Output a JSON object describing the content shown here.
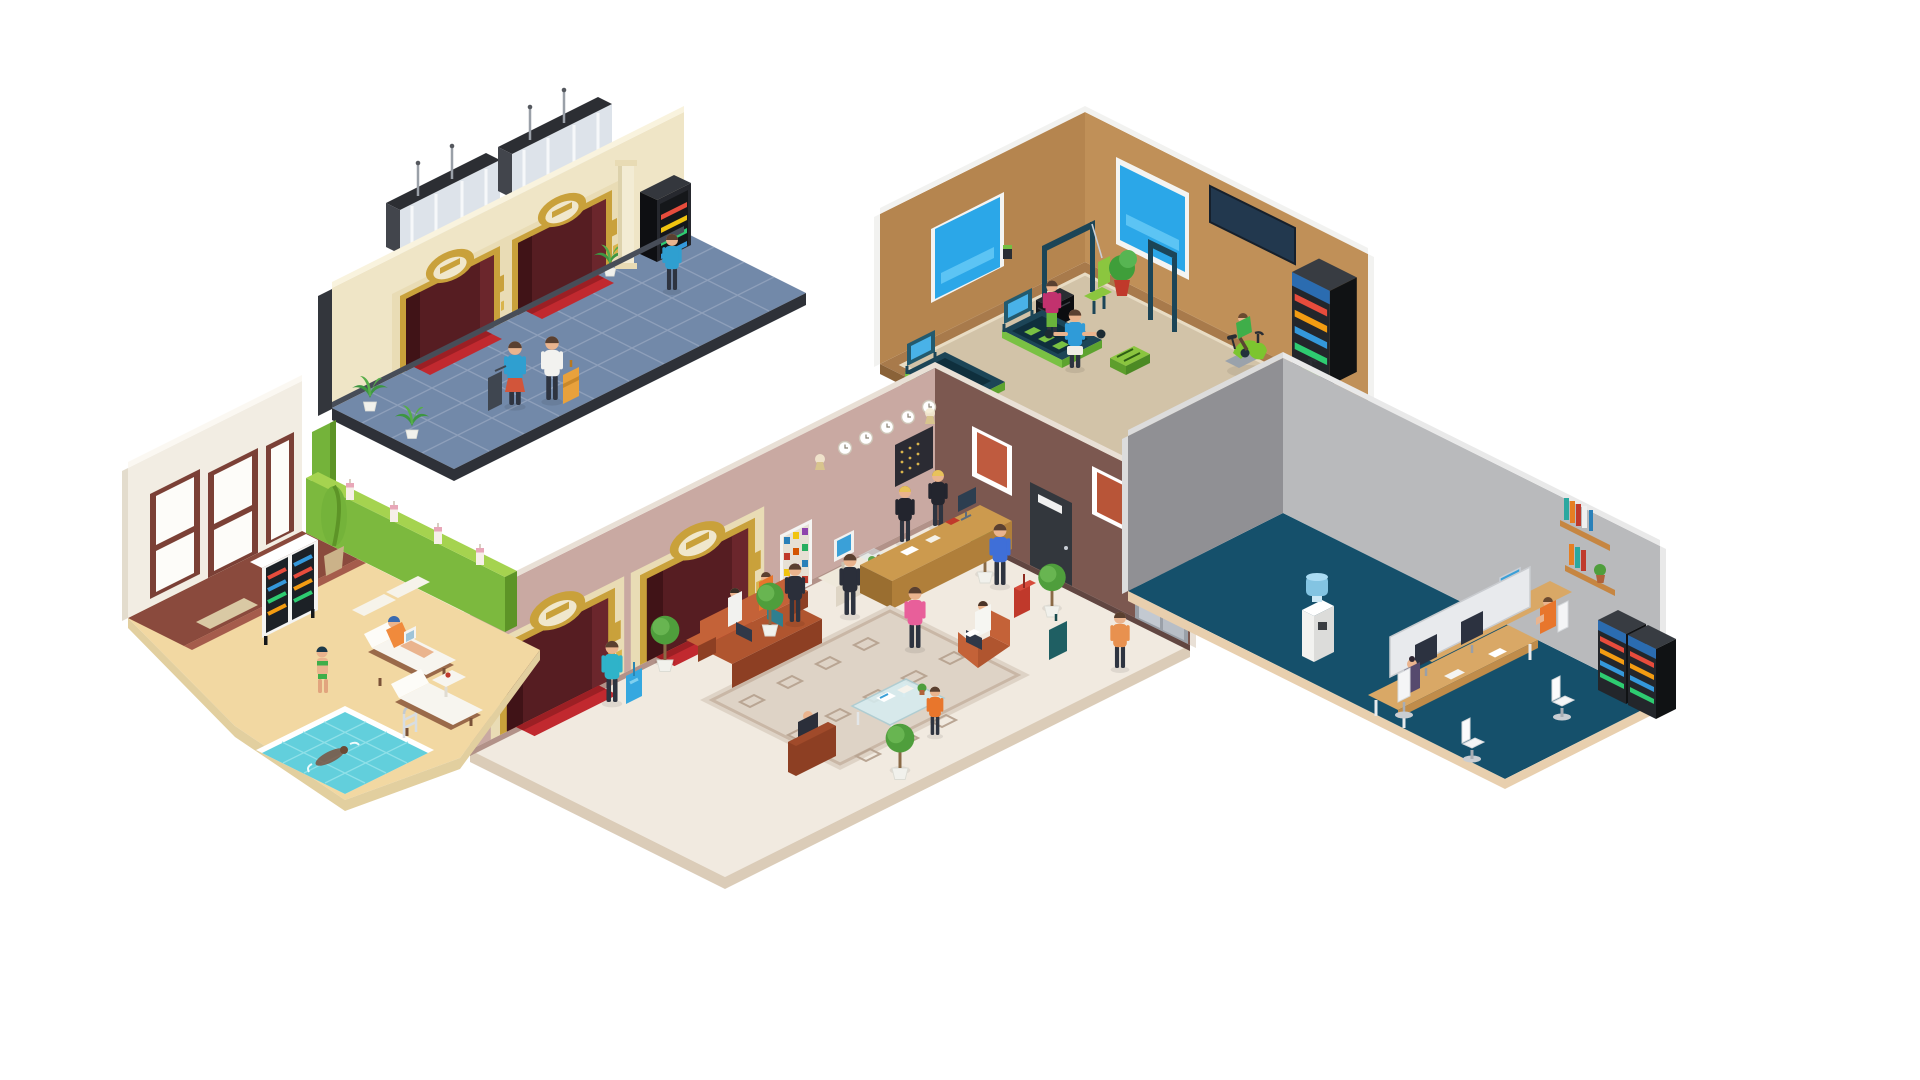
{
  "canvas": {
    "width": 1920,
    "height": 1080,
    "background": "#ffffff",
    "kind": "isometric vector illustration",
    "title": "Hotel interiors — five isometric scenes"
  },
  "scenes": [
    {
      "id": "elevator-hall",
      "name": "Elevator hall with two gold-framed elevators, shafts with antennas, snack vending machine, column, palms, blue tiled floor and guests with luggage"
    },
    {
      "id": "gym",
      "name": "Hotel gym with treadmills, runner, weight machine, man lifting dumbbells, exercise bikes, drinks vending machine, wall TV, windows and free weights"
    },
    {
      "id": "lobby",
      "name": "Reception lobby with desk and two clerks, wall clocks, key board, snack shelf, check-in kiosk, elevators, sofas with guests, glass coffee table, rug, topiary trees and walking guests"
    },
    {
      "id": "pool",
      "name": "Pool lounge with tiled swimming pool, swimmer, ladder, sun loungers, woman with laptop, drinks cooler, candles on green planter wall and tall windows"
    },
    {
      "id": "office",
      "name": "Staff office with double desk, monitors, office chairs, two workers, book shelves, water cooler and two drink fridges"
    }
  ],
  "palette": {
    "background": "#ffffff",
    "cream_wall": "#efe5c6",
    "mauve_wall": "#c9a9a2",
    "brown_wall": "#7c5850",
    "tan_wall": "#b5854f",
    "gray_wall_dark": "#909094",
    "gray_wall_light": "#b9babc",
    "pool_wall": "#f2ede3",
    "blue_tile_floor": "#7289a9",
    "lobby_floor": "#f1eae0",
    "gym_floor": "#d2c3a8",
    "office_floor": "#15506b",
    "sand_deck": "#f2d8a2",
    "pool_water": "#62cfdc",
    "gold_trim": "#c9a13b",
    "elevator_red": "#c1292f",
    "sofa_rust": "#b0552f",
    "gym_green": "#79c143",
    "wood": "#cc9a4e",
    "machine_black": "#23262b"
  }
}
